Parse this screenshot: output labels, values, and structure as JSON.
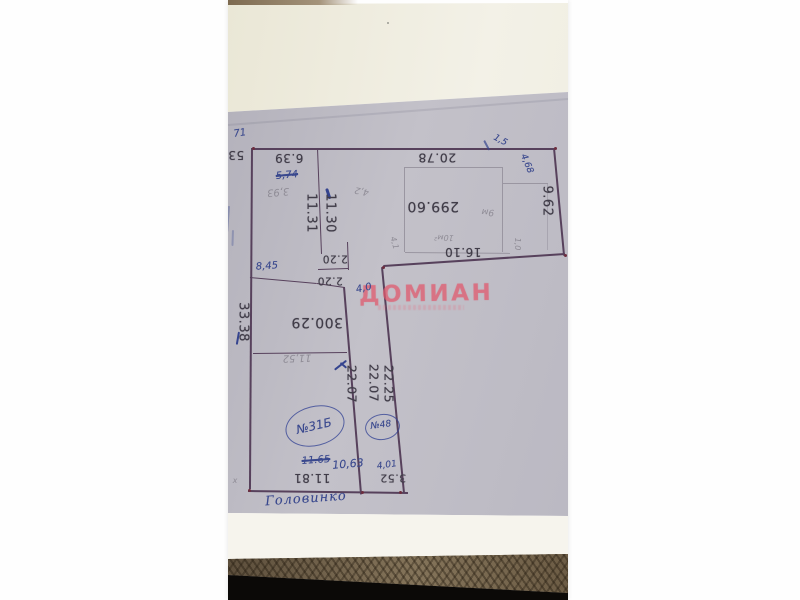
{
  "photo": {
    "description": "Photograph of a hand-drawn land-plot survey plan (BTI sketch) lying rotated 180 degrees on a textured couch arm",
    "colors": {
      "plan_paper": "#bcbac3",
      "top_paper": "#ece9da",
      "under_paper": "#f6f4ed",
      "fabric": "#6f604b",
      "ink_lines": "#57415c",
      "pencil_lines": "#9a96a1",
      "printed_text": "#403c48",
      "pen_notes": "#39488e",
      "pencil_notes": "#8f8c96",
      "watermark": "#e05a6e"
    }
  },
  "plan": {
    "watermark": {
      "text": "ДОМИАН"
    },
    "labels": [
      {
        "text": "53",
        "x": 8,
        "y": 155,
        "rot": 180,
        "size": 12,
        "cls": "print",
        "name": "dimension-label"
      },
      {
        "text": "6.39",
        "x": 61,
        "y": 158,
        "rot": 180,
        "size": 12,
        "cls": "print",
        "name": "dimension-label"
      },
      {
        "text": "20.78",
        "x": 209,
        "y": 157,
        "rot": 180,
        "size": 12.5,
        "cls": "print",
        "name": "dimension-label"
      },
      {
        "text": "299.60",
        "x": 205,
        "y": 206,
        "rot": 180,
        "size": 14,
        "cls": "print",
        "name": "area-label"
      },
      {
        "text": "16.10",
        "x": 235,
        "y": 252,
        "rot": 180,
        "size": 12,
        "cls": "print",
        "name": "dimension-label"
      },
      {
        "text": "300.29",
        "x": 89,
        "y": 322,
        "rot": 180,
        "size": 14,
        "cls": "print",
        "name": "area-label"
      },
      {
        "text": "2.20",
        "x": 107,
        "y": 258,
        "rot": 180,
        "size": 10.5,
        "cls": "print",
        "name": "dimension-label"
      },
      {
        "text": "2.20",
        "x": 102,
        "y": 280,
        "rot": 180,
        "size": 10.5,
        "cls": "print",
        "name": "dimension-label"
      },
      {
        "text": "11.81",
        "x": 84,
        "y": 478,
        "rot": 180,
        "size": 12,
        "cls": "print",
        "name": "dimension-label"
      },
      {
        "text": "3.52",
        "x": 165,
        "y": 478,
        "rot": 180,
        "size": 11,
        "cls": "print",
        "name": "dimension-label"
      },
      {
        "text": "33.38",
        "x": 15,
        "y": 322,
        "rot": 90,
        "size": 13,
        "cls": "print",
        "name": "dimension-label"
      },
      {
        "text": "11.31",
        "x": 83,
        "y": 213,
        "rot": 90,
        "size": 13,
        "cls": "print",
        "name": "dimension-label"
      },
      {
        "text": "11.30",
        "x": 102,
        "y": 213,
        "rot": 90,
        "size": 13,
        "cls": "print",
        "name": "dimension-label"
      },
      {
        "text": "22.07",
        "x": 123,
        "y": 384,
        "rot": 90,
        "size": 12.5,
        "cls": "print",
        "name": "dimension-label"
      },
      {
        "text": "22.07",
        "x": 145,
        "y": 383,
        "rot": 90,
        "size": 12.5,
        "cls": "print",
        "name": "dimension-label"
      },
      {
        "text": "22.25",
        "x": 160,
        "y": 384,
        "rot": 90,
        "size": 12.5,
        "cls": "print",
        "name": "dimension-label"
      },
      {
        "text": "9.62",
        "x": 319,
        "y": 201,
        "rot": 90,
        "size": 13,
        "cls": "print",
        "name": "dimension-label"
      },
      {
        "text": "71",
        "x": 12,
        "y": 134,
        "rot": -8,
        "size": 10,
        "cls": "pen",
        "name": "handwritten-note"
      },
      {
        "text": "5,74",
        "x": 59,
        "y": 176,
        "rot": -5,
        "size": 10,
        "cls": "pen strike",
        "name": "handwritten-note"
      },
      {
        "text": "8,45",
        "x": 39,
        "y": 267,
        "rot": -4,
        "size": 10,
        "cls": "pen",
        "name": "handwritten-note"
      },
      {
        "text": "4,0",
        "x": 136,
        "y": 289,
        "rot": -12,
        "size": 10,
        "cls": "pen",
        "name": "handwritten-note"
      },
      {
        "text": "11.65",
        "x": 88,
        "y": 461,
        "rot": -4,
        "size": 10,
        "cls": "pen strike",
        "name": "handwritten-note"
      },
      {
        "text": "10,63",
        "x": 120,
        "y": 464,
        "rot": -5,
        "size": 11,
        "cls": "pen",
        "name": "handwritten-note"
      },
      {
        "text": "4,01",
        "x": 159,
        "y": 466,
        "rot": -8,
        "size": 9,
        "cls": "pen",
        "name": "handwritten-note"
      },
      {
        "text": "1,5",
        "x": 272,
        "y": 141,
        "rot": 28,
        "size": 9,
        "cls": "pen",
        "name": "handwritten-note"
      },
      {
        "text": "4,68",
        "x": 298,
        "y": 164,
        "rot": 68,
        "size": 9,
        "cls": "pen",
        "name": "handwritten-note"
      },
      {
        "text": "№31Б",
        "x": 86,
        "y": 426,
        "rot": -13,
        "size": 12,
        "cls": "pen",
        "name": "parcel-number"
      },
      {
        "text": "№48",
        "x": 153,
        "y": 426,
        "rot": -8,
        "size": 9,
        "cls": "pen",
        "name": "parcel-number"
      },
      {
        "text": "Головинко",
        "x": 78,
        "y": 499,
        "rot": -4,
        "size": 13,
        "cls": "pen cursive",
        "name": "street-name"
      },
      {
        "text": "3,93",
        "x": 50,
        "y": 191,
        "rot": 175,
        "size": 10,
        "cls": "pencil",
        "name": "handwritten-note"
      },
      {
        "text": "11,52",
        "x": 69,
        "y": 357,
        "rot": 178,
        "size": 10,
        "cls": "pencil",
        "name": "handwritten-note"
      },
      {
        "text": "4,2",
        "x": 134,
        "y": 190,
        "rot": 192,
        "size": 9,
        "cls": "pencil",
        "name": "handwritten-note"
      },
      {
        "text": "9м",
        "x": 260,
        "y": 211,
        "rot": 185,
        "size": 9,
        "cls": "pencil",
        "name": "handwritten-note"
      },
      {
        "text": "10м²",
        "x": 216,
        "y": 237,
        "rot": 182,
        "size": 8,
        "cls": "pencil",
        "name": "handwritten-note"
      },
      {
        "text": "4,1",
        "x": 166,
        "y": 243,
        "rot": 75,
        "size": 8,
        "cls": "pencil",
        "name": "handwritten-note"
      },
      {
        "text": "1,0",
        "x": 289,
        "y": 244,
        "rot": 90,
        "size": 8,
        "cls": "pencil",
        "name": "handwritten-note"
      },
      {
        "text": "х",
        "x": 7,
        "y": 481,
        "rot": 0,
        "size": 8,
        "cls": "pencil",
        "name": "handwritten-note"
      }
    ]
  }
}
